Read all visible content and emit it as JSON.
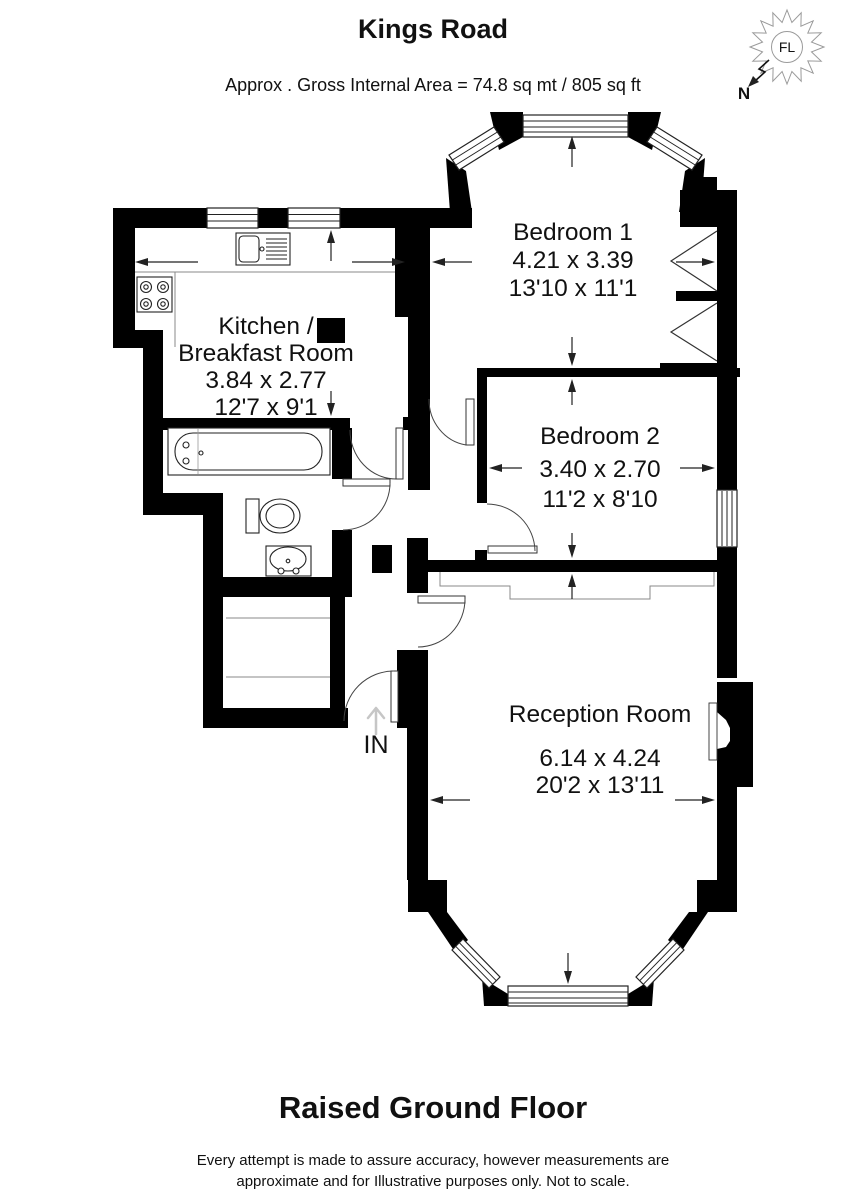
{
  "header": {
    "title": "Kings Road",
    "subtitle": "Approx . Gross Internal Area = 74.8 sq mt / 805 sq ft"
  },
  "compass": {
    "center_label": "FL",
    "north_label": "N"
  },
  "rooms": {
    "bedroom1": {
      "name": "Bedroom 1",
      "metric": "4.21 x 3.39",
      "imperial": "13'10 x 11'1"
    },
    "bedroom2": {
      "name": "Bedroom 2",
      "metric": "3.40 x 2.70",
      "imperial": "11'2 x 8'10"
    },
    "kitchen": {
      "name_line1": "Kitchen /",
      "name_line2": "Breakfast Room",
      "metric": "3.84 x 2.77",
      "imperial": "12'7 x 9'1"
    },
    "reception": {
      "name": "Reception Room",
      "metric": "6.14 x 4.24",
      "imperial": "20'2 x 13'11"
    }
  },
  "entrance": {
    "label": "IN"
  },
  "floor": {
    "label": "Raised Ground Floor"
  },
  "disclaimer": {
    "line1": "Every attempt is made to assure accuracy, however measurements are",
    "line2": "approximate and for Illustrative purposes only. Not to scale."
  }
}
